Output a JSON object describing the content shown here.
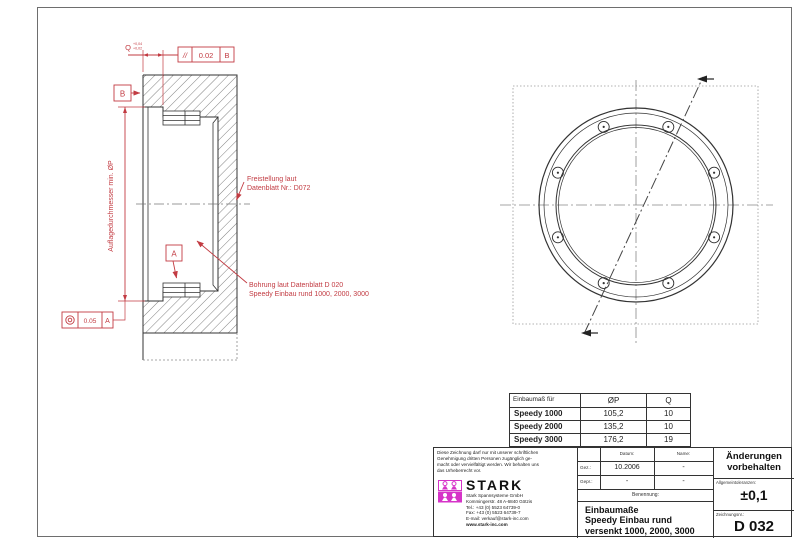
{
  "colors": {
    "annotation_red": "#c23b42",
    "logo_magenta": "#d633c8",
    "line_dark": "#333333"
  },
  "section_view": {
    "datum_b": "B",
    "datum_a": "A",
    "q_label": "Q",
    "q_tol_upper": "+0,04",
    "q_tol_lower": "+0,02",
    "parallelism": {
      "symbol": "//",
      "value": "0.02",
      "datum": "B"
    },
    "concentricity": {
      "value": "0.05",
      "datum": "A"
    },
    "diameter_label": "Auflagedurchmesser min. ØP",
    "note_freistellung_line1": "Freistellung laut",
    "note_freistellung_line2": "Datenblatt Nr.: D072",
    "note_bohrung_line1": "Bohrung laut Datenblatt D 020",
    "note_bohrung_line2": "Speedy Einbau rund 1000, 2000, 3000"
  },
  "dimension_table": {
    "col_headers": [
      "Einbaumaß für",
      "ØP",
      "Q"
    ],
    "rows": [
      {
        "name": "Speedy 1000",
        "p": "105,2",
        "q": "10"
      },
      {
        "name": "Speedy 2000",
        "p": "135,2",
        "q": "10"
      },
      {
        "name": "Speedy 3000",
        "p": "176,2",
        "q": "19"
      }
    ]
  },
  "title_block": {
    "copyright": {
      "line1": "Diese Zeichnung darf nur mit unserer schriftlichen",
      "line2": "Genehmigung dritten Personen zugänglich ge-",
      "line3": "macht oder vervielfältigt werden. Wir behalten uns",
      "line4": "das Urheberrecht vor."
    },
    "company": {
      "logo_text": "STARK",
      "name": "Stark Spannsysteme GmbH",
      "address": "Kommingerstr. 48 A-6840 Götzis",
      "tel": "Tel.: +43 (0) 5523 64739-0",
      "fax": "Fax: +43 (0) 5523 64739-7",
      "email": "E-mail: verkauf@stark-inc.com",
      "web": "www.stark-inc.com"
    },
    "fields": {
      "datum_header": "Datum:",
      "name_header": "Name:",
      "gez_label": "Gez.:",
      "gez_datum": "10.2006",
      "gez_name": "-",
      "gepr_label": "Gepr.:",
      "gepr_datum": "-",
      "gepr_name": "-",
      "benennung_label": "Benennung:"
    },
    "title_line1": "Einbaumaße",
    "title_line2": "Speedy Einbau rund",
    "title_line3": "versenkt 1000, 2000, 3000",
    "aenderungen_line1": "Änderungen",
    "aenderungen_line2": "vorbehalten",
    "tolerances_label": "Allgemeintoleranzen:",
    "tolerances_value": "±0,1",
    "drawing_no_label": "Zeichnungsnr.:",
    "drawing_no": "D 032"
  }
}
